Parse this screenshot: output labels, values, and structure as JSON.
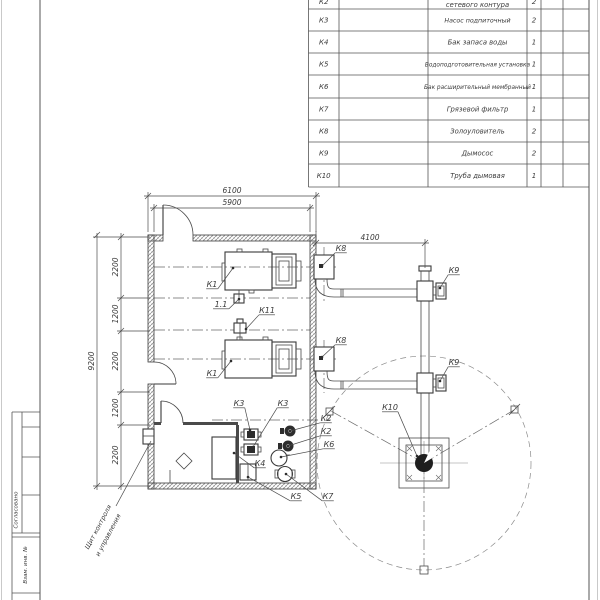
{
  "spec_table": {
    "rows": [
      {
        "pos": "К2",
        "name": "сетевого контура",
        "qty": "2",
        "partial": true
      },
      {
        "pos": "К3",
        "name": "Насос подпиточный",
        "qty": "2"
      },
      {
        "pos": "К4",
        "name": "Бак запаса воды",
        "qty": "1"
      },
      {
        "pos": "К5",
        "name": "Водоподготовительная установка",
        "qty": "1"
      },
      {
        "pos": "К6",
        "name": "Бак расширительный мембранный",
        "qty": "1"
      },
      {
        "pos": "К7",
        "name": "Грязевой фильтр",
        "qty": "1"
      },
      {
        "pos": "К8",
        "name": "Золоуловитель",
        "qty": "2"
      },
      {
        "pos": "К9",
        "name": "Дымосос",
        "qty": "2"
      },
      {
        "pos": "К10",
        "name": "Труба дымовая",
        "qty": "1"
      }
    ]
  },
  "dimensions": [
    {
      "t": "6100",
      "x": 232,
      "y": 193,
      "r": 0
    },
    {
      "t": "5900",
      "x": 232,
      "y": 205,
      "r": 0
    },
    {
      "t": "4100",
      "x": 370,
      "y": 240,
      "r": 0
    },
    {
      "t": "9200",
      "x": 94,
      "y": 361,
      "r": -90
    },
    {
      "t": "2200",
      "x": 118,
      "y": 267,
      "r": -90
    },
    {
      "t": "1200",
      "x": 118,
      "y": 314,
      "r": -90
    },
    {
      "t": "2200",
      "x": 118,
      "y": 361,
      "r": -90
    },
    {
      "t": "1200",
      "x": 118,
      "y": 408,
      "r": -90
    },
    {
      "t": "2200",
      "x": 118,
      "y": 455,
      "r": -90
    }
  ],
  "labels": [
    {
      "t": "К1",
      "x": 212,
      "y": 287,
      "px": 233,
      "py": 268
    },
    {
      "t": "1.1",
      "x": 221,
      "y": 307,
      "px": 239,
      "py": 299
    },
    {
      "t": "К11",
      "x": 267,
      "y": 313,
      "px": 246,
      "py": 329
    },
    {
      "t": "К1",
      "x": 212,
      "y": 376,
      "px": 231,
      "py": 361
    },
    {
      "t": "К8",
      "x": 341,
      "y": 251,
      "px": 322,
      "py": 266
    },
    {
      "t": "К9",
      "x": 454,
      "y": 273,
      "px": 440,
      "py": 288
    },
    {
      "t": "К8",
      "x": 341,
      "y": 343,
      "px": 322,
      "py": 357
    },
    {
      "t": "К9",
      "x": 454,
      "y": 365,
      "px": 440,
      "py": 381
    },
    {
      "t": "К10",
      "x": 390,
      "y": 410,
      "px": 417,
      "py": 456
    },
    {
      "t": "К3",
      "x": 239,
      "y": 406,
      "px": 250,
      "py": 430
    },
    {
      "t": "К3",
      "x": 283,
      "y": 406,
      "px": 253,
      "py": 447
    },
    {
      "t": "К2",
      "x": 326,
      "y": 421,
      "px": 290,
      "py": 431
    },
    {
      "t": "К2",
      "x": 326,
      "y": 434,
      "px": 288,
      "py": 446
    },
    {
      "t": "К6",
      "x": 329,
      "y": 447,
      "px": 281,
      "py": 457
    },
    {
      "t": "К4",
      "x": 260,
      "y": 466,
      "px": 234,
      "py": 453
    },
    {
      "t": "К5",
      "x": 296,
      "y": 499,
      "px": 248,
      "py": 477
    },
    {
      "t": "К7",
      "x": 328,
      "y": 499,
      "px": 286,
      "py": 474
    }
  ],
  "note": {
    "lines": [
      "Щит контроля",
      "и управления"
    ]
  },
  "stamp": {
    "labels": [
      "Согласовано",
      "Взам. инв. №"
    ]
  }
}
